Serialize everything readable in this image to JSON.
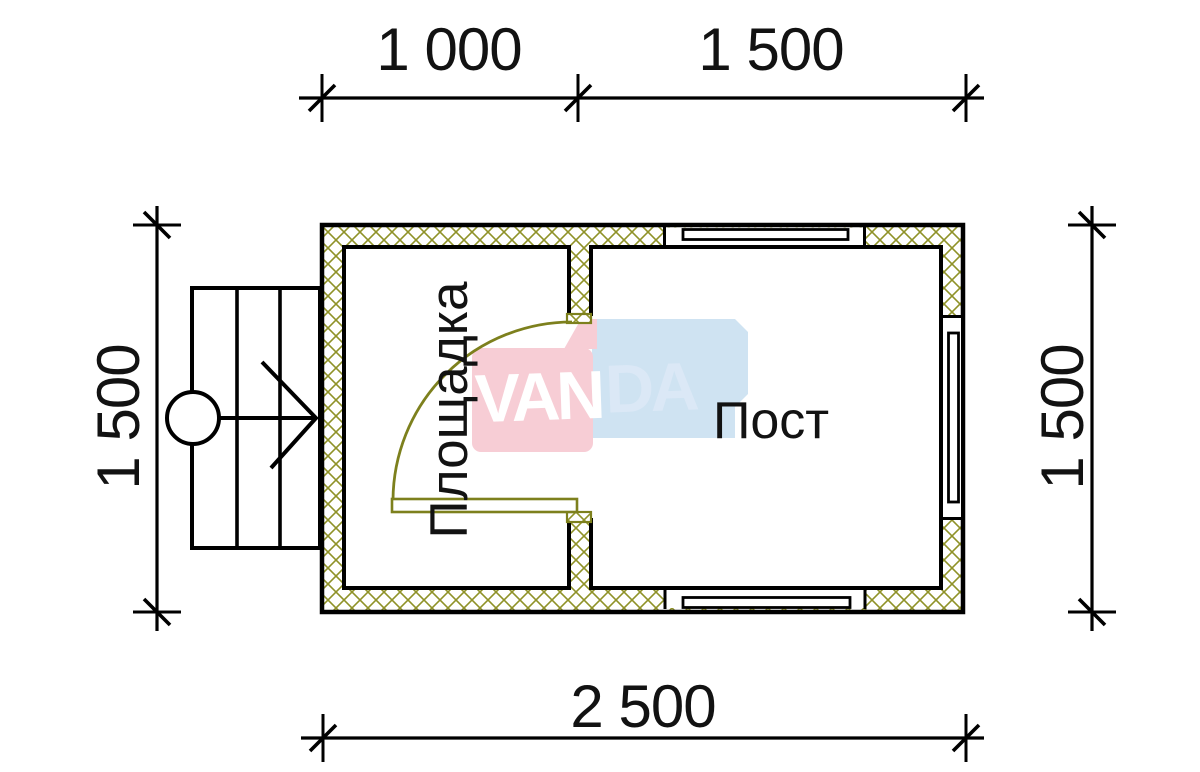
{
  "drawing": {
    "dimensions": {
      "top_left": "1 000",
      "top_right": "1 500",
      "left": "1 500",
      "right": "1 500",
      "bottom": "2 500"
    },
    "rooms": {
      "porch": "Площадка",
      "post": "Пост"
    },
    "watermark": {
      "van": "VAN",
      "da": "DA"
    },
    "colors": {
      "hatch_olive": "#8f9228",
      "door_olive": "#7d801d",
      "logo_pink": "#f7cdd5",
      "logo_blue": "#cfe3f2",
      "logo_da_text": "#dbe8f6",
      "line_black": "#000000"
    }
  }
}
